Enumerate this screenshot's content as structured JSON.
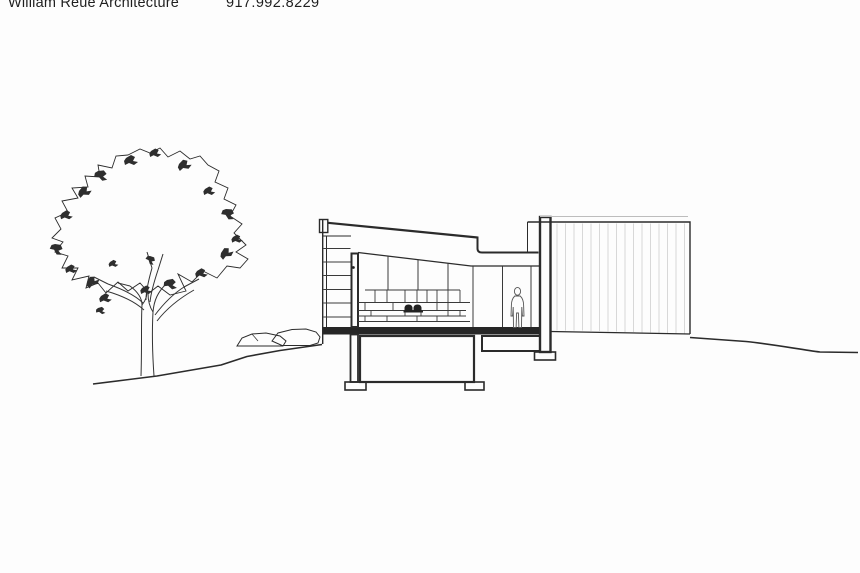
{
  "page": {
    "background_color": "#fdfdfd",
    "ink_color": "#2b2b2b",
    "cladding_line_color": "#cfcfcf"
  },
  "header": {
    "firm_name": "William Reue Architecture",
    "phone": "917.992.8229"
  },
  "drawing": {
    "type": "architectural-section-elevation",
    "elements": {
      "tree": "deciduous-tree",
      "ground": "grade-line",
      "boulders": "boulders-at-grade",
      "house_section": "sectioned-volume-with-shed-roof-glazing-millwork-basement",
      "clad_volume": "tall-vertically-clad-volume",
      "human_figure": "standing-scale-figure"
    }
  }
}
